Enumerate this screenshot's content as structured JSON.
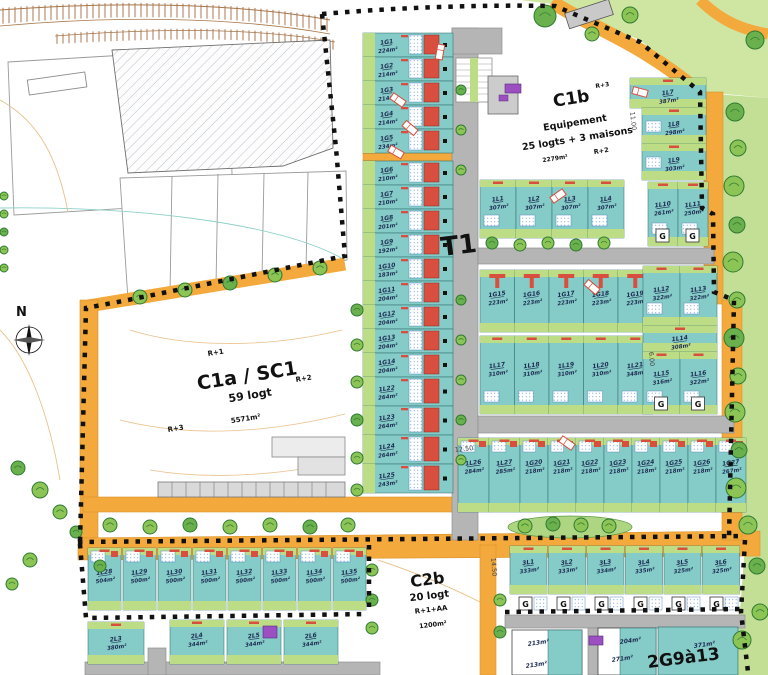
{
  "plan": {
    "t1_label": "T1",
    "compass_n": "N",
    "garage_letter": "G",
    "zones": {
      "c1a": {
        "name": "C1a / SC1",
        "logt": "59 logt",
        "area": "5571m²",
        "r1": "R+1",
        "r2": "R+2",
        "r3": "R+3"
      },
      "c1b": {
        "name": "C1b",
        "r3": "R+3",
        "line1": "Equipement",
        "line2": "25 logts + 3 maisons",
        "area": "2279m²",
        "r2": "R+2"
      },
      "c2b": {
        "name": "C2b",
        "logt": "20 logt",
        "floors": "R+1+AA",
        "area": "1200m²"
      },
      "g2913": {
        "name": "2G9à13",
        "areas": [
          "213m²",
          "213m²",
          "204m²",
          "271m²",
          "371m²"
        ]
      }
    },
    "dims": {
      "d11": "11.00",
      "d125": "12.50",
      "d6": "6.00",
      "d145": "14.50"
    },
    "rows": {
      "left_strip": [
        {
          "id": "1G1",
          "area": "224m²"
        },
        {
          "id": "1G2",
          "area": "214m²"
        },
        {
          "id": "1G3",
          "area": "214m²"
        },
        {
          "id": "1G4",
          "area": "214m²"
        },
        {
          "id": "1G5",
          "area": "234m²"
        },
        {
          "id": "1G6",
          "area": "210m²"
        },
        {
          "id": "1G7",
          "area": "210m²"
        },
        {
          "id": "1G8",
          "area": "201m²"
        },
        {
          "id": "1G9",
          "area": "192m²"
        },
        {
          "id": "1G10",
          "area": "183m²"
        },
        {
          "id": "1G11",
          "area": "204m²"
        },
        {
          "id": "1G12",
          "area": "204m²"
        },
        {
          "id": "1G13",
          "area": "204m²"
        },
        {
          "id": "1G14",
          "area": "204m²"
        },
        {
          "id": "1L22",
          "area": "264m²"
        },
        {
          "id": "1L23",
          "area": "264m²"
        },
        {
          "id": "1L24",
          "area": "264m²"
        },
        {
          "id": "1L25",
          "area": "243m²"
        }
      ],
      "c1b_row": [
        {
          "id": "1L1",
          "area": "307m²"
        },
        {
          "id": "1L2",
          "area": "307m²"
        },
        {
          "id": "1L3",
          "area": "307m²"
        },
        {
          "id": "1L4",
          "area": "307m²"
        }
      ],
      "right_upper": [
        {
          "id": "1L7",
          "area": "387m²"
        },
        {
          "id": "1L8",
          "area": "298m²"
        },
        {
          "id": "1L9",
          "area": "303m²"
        },
        {
          "id": "1L10",
          "area": "261m²"
        },
        {
          "id": "1L11",
          "area": "250m²"
        }
      ],
      "garage_row": [
        {
          "id": "1G15",
          "area": "223m²"
        },
        {
          "id": "1G16",
          "area": "223m²"
        },
        {
          "id": "1G17",
          "area": "223m²"
        },
        {
          "id": "1G18",
          "area": "223m²"
        },
        {
          "id": "1G19",
          "area": "223m²"
        }
      ],
      "mid_row": [
        {
          "id": "1L17",
          "area": "310m²"
        },
        {
          "id": "1L18",
          "area": "310m²"
        },
        {
          "id": "1L19",
          "area": "310m²"
        },
        {
          "id": "1L20",
          "area": "310m²"
        },
        {
          "id": "1L21",
          "area": "348m²"
        }
      ],
      "right_lower": [
        {
          "id": "1L12",
          "area": "322m²"
        },
        {
          "id": "1L13",
          "area": "322m²"
        },
        {
          "id": "1L14",
          "area": "308m²"
        },
        {
          "id": "1L15",
          "area": "316m²"
        },
        {
          "id": "1L16",
          "area": "322m²"
        }
      ],
      "bottom_mid": [
        {
          "id": "1L26",
          "area": "284m²"
        },
        {
          "id": "1L27",
          "area": "285m²"
        },
        {
          "id": "1G20",
          "area": "218m²"
        },
        {
          "id": "1G21",
          "area": "218m²"
        },
        {
          "id": "1G22",
          "area": "218m²"
        },
        {
          "id": "1G23",
          "area": "218m²"
        },
        {
          "id": "1G24",
          "area": "218m²"
        },
        {
          "id": "1G25",
          "area": "218m²"
        },
        {
          "id": "1G26",
          "area": "218m²"
        },
        {
          "id": "1G27",
          "area": "267m²"
        }
      ],
      "bottom_left": [
        {
          "id": "1L28",
          "area": "504m²"
        },
        {
          "id": "1L29",
          "area": "500m²"
        },
        {
          "id": "1L30",
          "area": "500m²"
        },
        {
          "id": "1L31",
          "area": "500m²"
        },
        {
          "id": "1L32",
          "area": "500m²"
        },
        {
          "id": "1L33",
          "area": "500m²"
        },
        {
          "id": "1L34",
          "area": "500m²"
        },
        {
          "id": "1L35",
          "area": "500m²"
        }
      ],
      "bottom_right": [
        {
          "id": "3L1",
          "area": "333m²"
        },
        {
          "id": "3L2",
          "area": "333m²"
        },
        {
          "id": "3L3",
          "area": "334m²"
        },
        {
          "id": "3L4",
          "area": "335m²"
        },
        {
          "id": "3L5",
          "area": "325m²"
        },
        {
          "id": "3L6",
          "area": "325m²"
        }
      ],
      "bottom_far_left": [
        {
          "id": "2L3",
          "area": "380m²"
        },
        {
          "id": "2L4",
          "area": "344m²"
        },
        {
          "id": "2L5",
          "area": "344m²"
        },
        {
          "id": "2L6",
          "area": "344m²"
        }
      ]
    },
    "colors": {
      "teal": "#85cbc7",
      "green_band": "#bcdd85",
      "verge": "#a8d175",
      "tree": "#8cc455",
      "orange_road": "#f3a93c",
      "gray_road": "#b5b5b5",
      "red": "#d84f3f",
      "purple": "#9b4fc0",
      "ink": "#1c2b52",
      "boundary": "#111111"
    }
  }
}
